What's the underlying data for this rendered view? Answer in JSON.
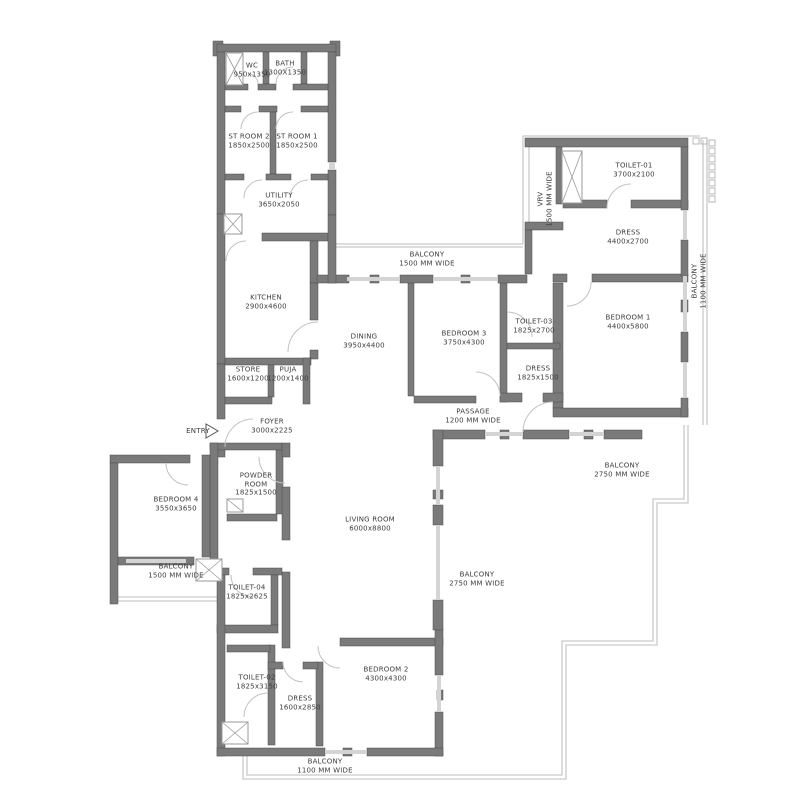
{
  "colors": {
    "wall": "#7a7a7a",
    "window_line": "#c9c9c9",
    "text": "#3d3d3d"
  },
  "entry": {
    "label": "ENTRY"
  },
  "rooms": {
    "wc": {
      "name": "WC",
      "dims": "950x1350"
    },
    "bath": {
      "name": "BATH",
      "dims": "1300X1350"
    },
    "st_room_2": {
      "name": "ST ROOM 2",
      "dims": "1850x2500"
    },
    "st_room_1": {
      "name": "ST ROOM 1",
      "dims": "1850x2500"
    },
    "utility": {
      "name": "UTILITY",
      "dims": "3650x2050"
    },
    "kitchen": {
      "name": "KITCHEN",
      "dims": "2900x4600"
    },
    "store": {
      "name": "STORE",
      "dims": "1600x1200"
    },
    "puja": {
      "name": "PUJA",
      "dims": "1200x1400"
    },
    "foyer": {
      "name": "FOYER",
      "dims": "3000x2225"
    },
    "dining": {
      "name": "DINING",
      "dims": "3950x4400"
    },
    "bedroom_3": {
      "name": "BEDROOM 3",
      "dims": "3750x4300"
    },
    "toilet_03": {
      "name": "TOILET-03",
      "dims": "1825x2700"
    },
    "dress_3": {
      "name": "DRESS",
      "dims": "1825x1500"
    },
    "vrv": {
      "name": "VRV",
      "dims": "1500 MM  WIDE"
    },
    "toilet_01": {
      "name": "TOILET-01",
      "dims": "3700x2100"
    },
    "dress_1": {
      "name": "DRESS",
      "dims": "4400x2700"
    },
    "bedroom_1": {
      "name": "BEDROOM 1",
      "dims": "4400x5800"
    },
    "passage": {
      "name": "PASSAGE",
      "dims": "1200 MM WIDE"
    },
    "living_room": {
      "name": "LIVING ROOM",
      "dims": "6000x8800"
    },
    "powder_room": {
      "name": "POWDER",
      "name2": "ROOM",
      "dims": "1825x1500"
    },
    "bedroom_4": {
      "name": "BEDROOM 4",
      "dims": "3550x3650"
    },
    "toilet_04": {
      "name": "TOILET-04",
      "dims": "1825x2625"
    },
    "bedroom_2": {
      "name": "BEDROOM 2",
      "dims": "4300x4300"
    },
    "toilet_02": {
      "name": "TOILET-02",
      "dims": "1825x3150"
    },
    "dress_2": {
      "name": "DRESS",
      "dims": "1600x2850"
    }
  },
  "balconies": {
    "top": {
      "name": "BALCONY",
      "dims": "1500 MM  WIDE"
    },
    "left": {
      "name": "BALCONY",
      "dims": "1500 MM  WIDE"
    },
    "right_1100": {
      "name": "BALCONY",
      "dims": "1100 MM WIDE"
    },
    "right_2750": {
      "name": "BALCONY",
      "dims": "2750 MM  WIDE"
    },
    "center_2750": {
      "name": "BALCONY",
      "dims": "2750 MM  WIDE"
    },
    "bottom_1100": {
      "name": "BALCONY",
      "dims": "1100 MM  WIDE"
    }
  }
}
